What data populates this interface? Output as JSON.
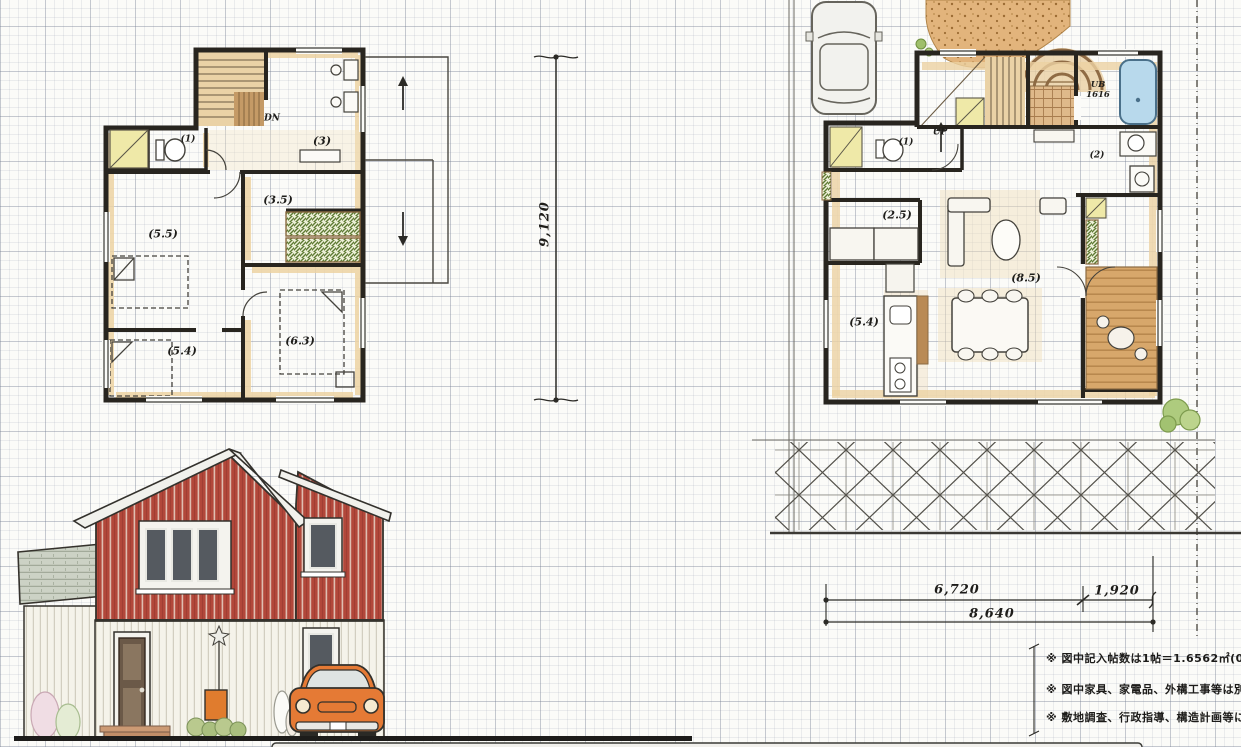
{
  "drawing": {
    "second_floor": {
      "stairs_label": "DN",
      "room_labels": {
        "toilet": "(1)",
        "hall": "(3)",
        "inner_room": "(3.5)",
        "bedroom_west": "(5.5)",
        "bedroom_south": "(5.4)",
        "bedroom_east": "(6.3)"
      }
    },
    "first_floor": {
      "stairs_label": "UP",
      "room_labels": {
        "toilet": "(1)",
        "bath_unit": "UB",
        "bath_size": "1616",
        "washroom": "(2)",
        "storage_room": "(2.5)",
        "kitchen": "(5.4)",
        "living_dining": "(8.5)"
      }
    },
    "dimensions": {
      "site_depth": "9,120",
      "width_main": "6,720",
      "width_side": "1,920",
      "width_total": "8,640"
    },
    "notes": [
      "※ 図中記入帖数は1帖＝1.6562㎡(0.91m",
      "※ 図中家具、家電品、外構工事等は別途",
      "※ 敷地調査、行政指導、構造計画等により"
    ],
    "palette": {
      "wall_ink": "#28251f",
      "tatami_beige": "#eacf9f",
      "wood_brown": "#c49a66",
      "deck_brown": "#d7a76b",
      "closet_yellow": "#efe9a8",
      "bath_blue": "#b8d9ec",
      "shelf_green": "#5e7a33",
      "house_red": "#b2473a",
      "car_orange": "#e57a35",
      "grid_gray": "#c3c7cf"
    }
  }
}
